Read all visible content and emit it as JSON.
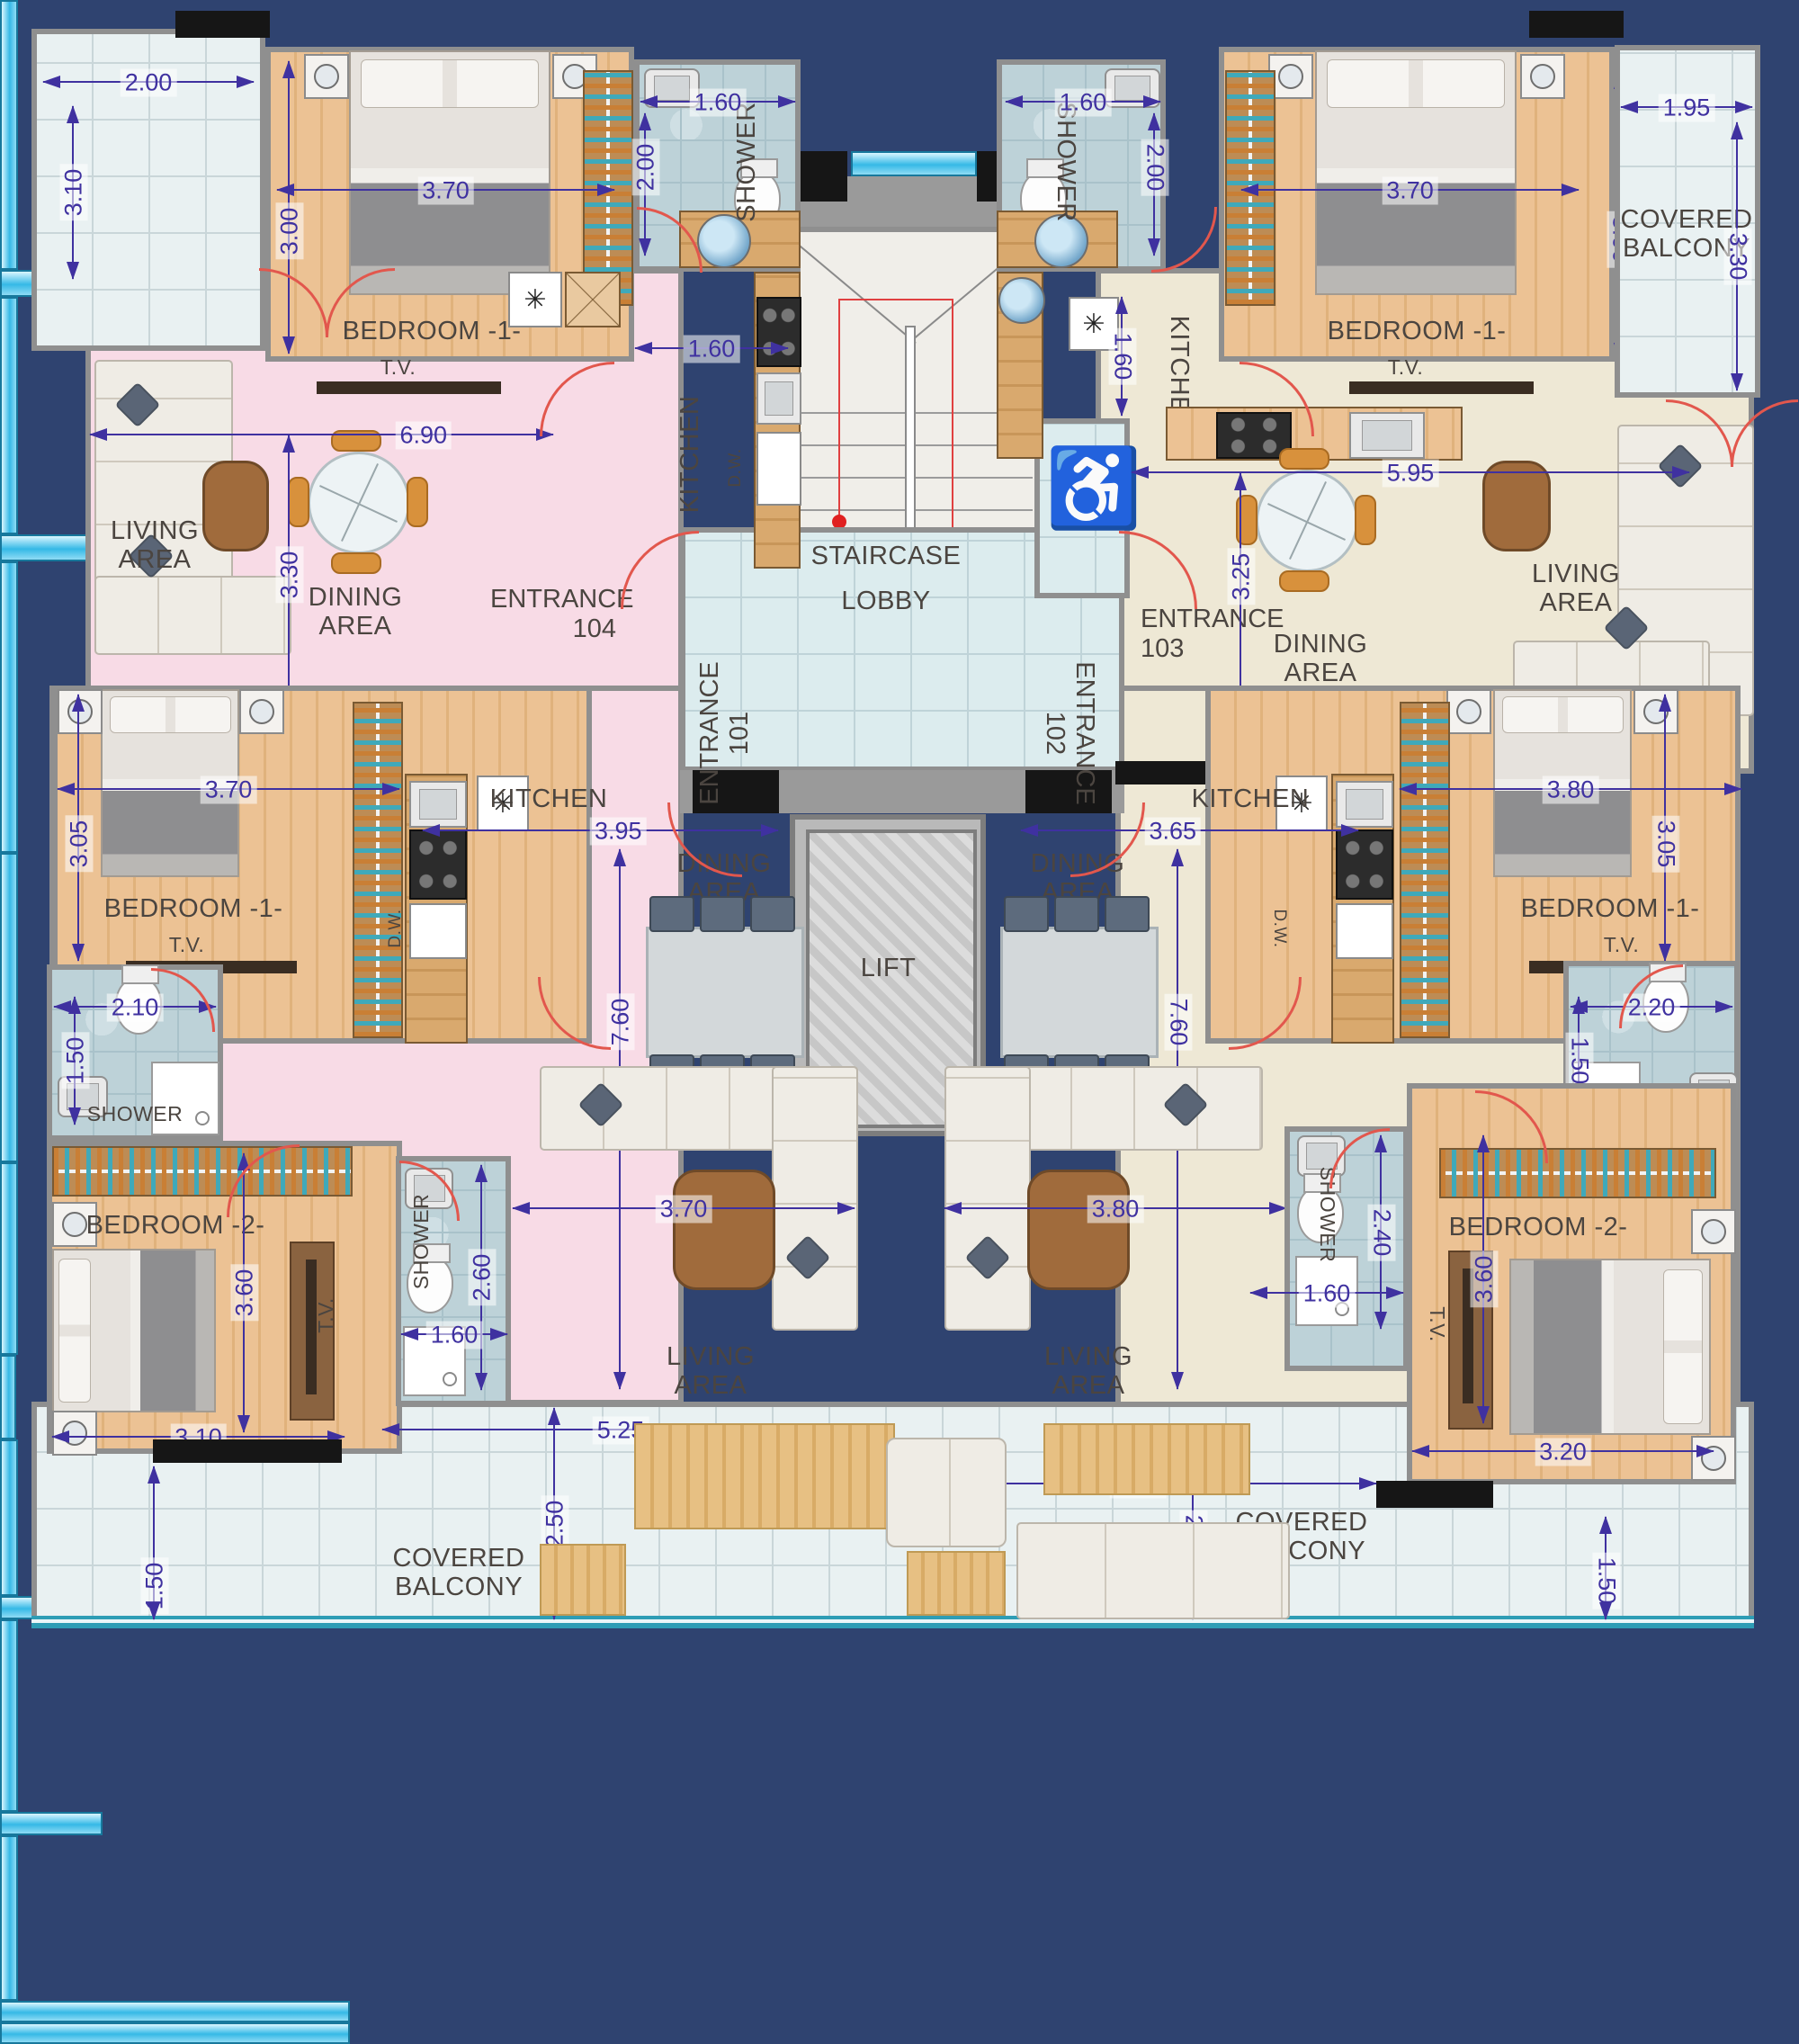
{
  "icons": {
    "wheelchair": "♿",
    "fixture": "✳"
  },
  "core": {
    "staircase": "STAIRCASE",
    "lobby": "LOBBY",
    "lift": "LIFT"
  },
  "entrances": {
    "e101": {
      "label": "ENTRANCE",
      "number": "101"
    },
    "e102": {
      "label": "ENTRANCE",
      "number": "102"
    },
    "e103": {
      "label": "ENTRANCE",
      "number": "103"
    },
    "e104": {
      "label": "ENTRANCE",
      "number": "104"
    }
  },
  "unit_tl": {
    "bedroom1": "BEDROOM -1-",
    "tv": "T.V.",
    "shower": "SHOWER",
    "kitchen": "KITCHEN",
    "dw": "D.W.",
    "living": "LIVING AREA",
    "dining": "DINING AREA",
    "dims": {
      "balcony_w": "2.00",
      "balcony_h": "3.10",
      "bed_w": "3.70",
      "bed_h": "3.00",
      "shower_w": "1.60",
      "shower_h": "2.00",
      "kitchen_w": "1.60",
      "living_w": "6.90",
      "living_h": "3.30"
    }
  },
  "unit_tr": {
    "bedroom1": "BEDROOM -1-",
    "tv": "T.V.",
    "shower": "SHOWER",
    "kitchen": "KITCHEN",
    "living": "LIVING AREA",
    "dining": "DINING AREA",
    "balcony": "COVERED BALCONY",
    "dims": {
      "shower_w": "1.60",
      "shower_h": "2.00",
      "kitchen_w": "1.60",
      "bed_w": "3.70",
      "bed_h": "3.00",
      "balcony_w": "1.95",
      "balcony_h": "3.30",
      "living_w": "5.95",
      "living_h": "3.25"
    }
  },
  "unit_bl": {
    "bedroom1": "BEDROOM -1-",
    "tv1": "T.V.",
    "shower1": "SHOWER",
    "kitchen": "KITCHEN",
    "dw": "D.W.",
    "dining": "DINING AREA",
    "living": "LIVING AREA",
    "bedroom2": "BEDROOM -2-",
    "tv2": "T.V.",
    "shower2": "SHOWER",
    "balcony": "COVERED BALCONY",
    "dims": {
      "bed1_w": "3.70",
      "bed1_h": "3.05",
      "shower1_w": "2.10",
      "shower1_h": "1.50",
      "kitchen_w": "3.95",
      "unit_h": "7.60",
      "living_w": "3.70",
      "shower2_h": "2.60",
      "shower2_w": "1.60",
      "bed2_h": "3.60",
      "bed2_w": "3.10",
      "balcony_w": "5.25",
      "balcony_h": "2.50",
      "balcony_side": "1.50"
    }
  },
  "unit_br": {
    "bedroom1": "BEDROOM -1-",
    "tv1": "T.V.",
    "shower1": "SHOWER",
    "kitchen": "KITCHEN",
    "dw": "D.W.",
    "dining": "DINING AREA",
    "living": "LIVING AREA",
    "bedroom2": "BEDROOM -2-",
    "tv2": "T.V.",
    "shower2": "SHOWER",
    "balcony": "COVERED BALCONY",
    "dims": {
      "bed1_w": "3.80",
      "bed1_h": "3.05",
      "shower1_w": "2.20",
      "shower1_h": "1.50",
      "kitchen_w": "3.65",
      "unit_h": "7.60",
      "living_w": "3.80",
      "shower2_h": "2.40",
      "shower2_w": "1.60",
      "bed2_h": "3.60",
      "bed2_w": "3.20",
      "balcony_w": "5.25",
      "balcony_h": "2.50",
      "balcony_side": "1.50"
    }
  }
}
